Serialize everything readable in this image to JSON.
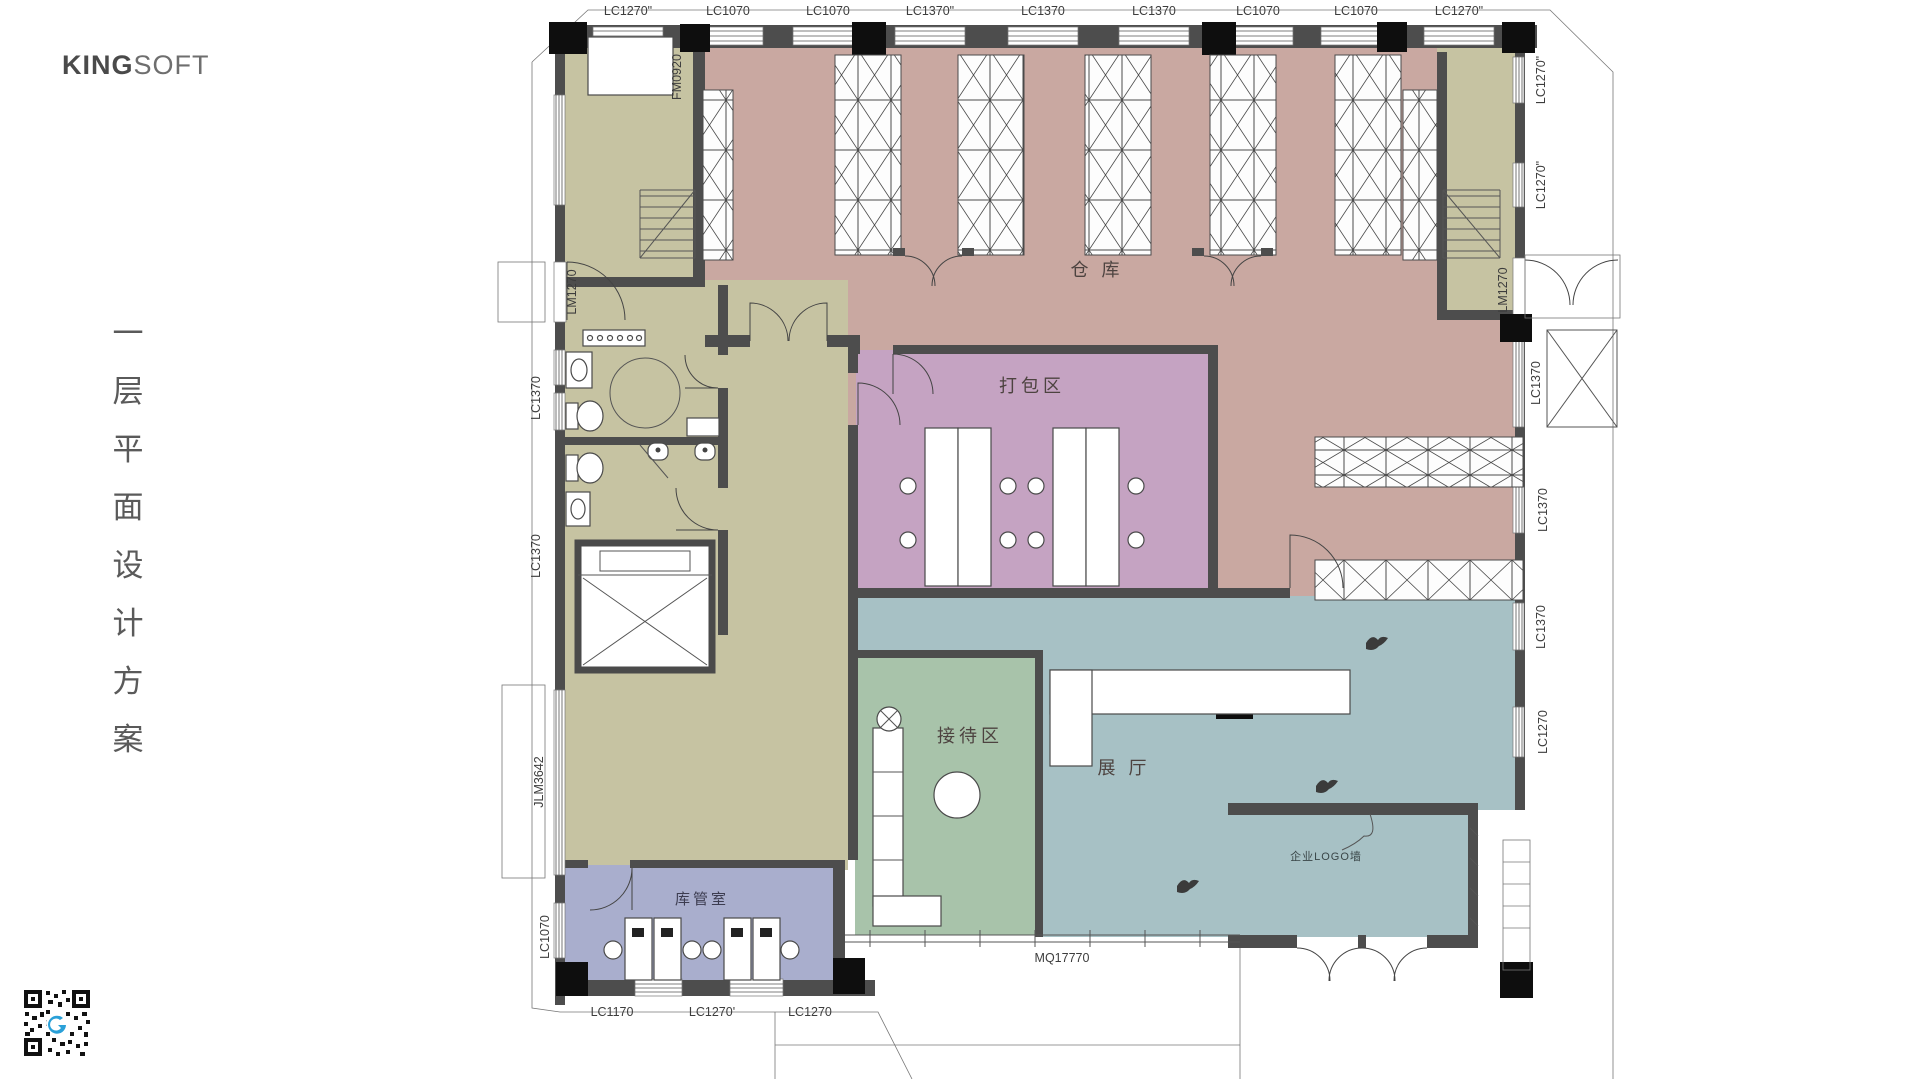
{
  "logo": {
    "bold": "KING",
    "light": "SOFT"
  },
  "side_title": {
    "chars": [
      "一",
      "层",
      "平",
      "面",
      "设",
      "计",
      "方",
      "案"
    ]
  },
  "rooms": {
    "warehouse": "仓 库",
    "packing": "打包区",
    "reception": "接待区",
    "exhibition": "展 厅",
    "storekeeper": "库管室",
    "logo_wall": "企业LOGO墙"
  },
  "dims": {
    "top": [
      "LC1270\"",
      "LC1070",
      "LC1070",
      "LC1370\"",
      "LC1370",
      "LC1370",
      "LC1070",
      "LC1070",
      "LC1270\""
    ],
    "left": [
      "LM1270",
      "LC1370",
      "LC1370",
      "JLM3642",
      "LC1070"
    ],
    "right": [
      "LC1270\"",
      "LC1270\"",
      "LM1270",
      "LC1370",
      "LC1370",
      "LC1370",
      "LC1270"
    ],
    "bottom": [
      "LC1170",
      "LC1270'",
      "LC1270"
    ],
    "curtain_wall": "MQ17770",
    "fire_door": "FM0920"
  },
  "colors": {
    "warehouse": "#c9a8a1",
    "packing": "#c5a3c2",
    "reception": "#a8c3aa",
    "exhibition": "#a7c1c5",
    "storekeeper": "#a9aecd",
    "stair_room": "#c6c3a2",
    "wall": "#4d4d4d",
    "qr_logo": "#2aa0d8"
  }
}
